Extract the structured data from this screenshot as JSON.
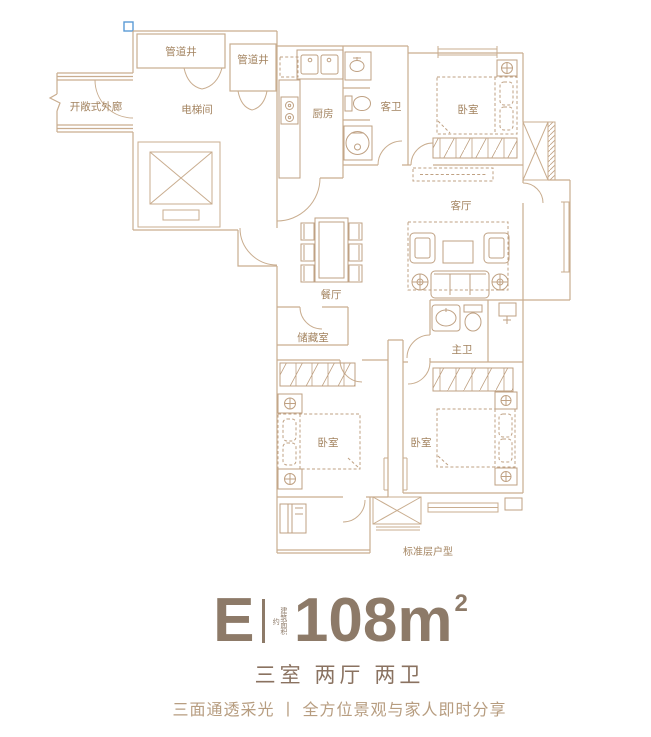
{
  "plan": {
    "rooms": {
      "pipe_shaft_1": "管道井",
      "pipe_shaft_2": "管道井",
      "open_corridor": "开敞式外廊",
      "elevator_hall": "电梯间",
      "kitchen": "厨房",
      "guest_bath": "客卫",
      "bedroom_top": "卧室",
      "living_room": "客厅",
      "dining_room": "餐厅",
      "storage": "储藏室",
      "master_bath": "主卫",
      "bedroom_left": "卧室",
      "bedroom_right": "卧室"
    },
    "caption": "标准层户型"
  },
  "title": {
    "unit": "E",
    "area_note": "建筑面积约",
    "area_value": "108m",
    "area_exponent": "2",
    "layout": "三室 两厅 两卫",
    "tagline": "三面通透采光 丨 全方位景观与家人即时分享"
  },
  "colors": {
    "wall_line": "#c9ad8f",
    "furniture_line": "#bfa183",
    "label_text": "#a3835f",
    "title_text": "#8d7a68",
    "subtitle_text": "#8a7260",
    "tagline_text": "#b79d80",
    "marker_blue": "#5a9bd5"
  }
}
